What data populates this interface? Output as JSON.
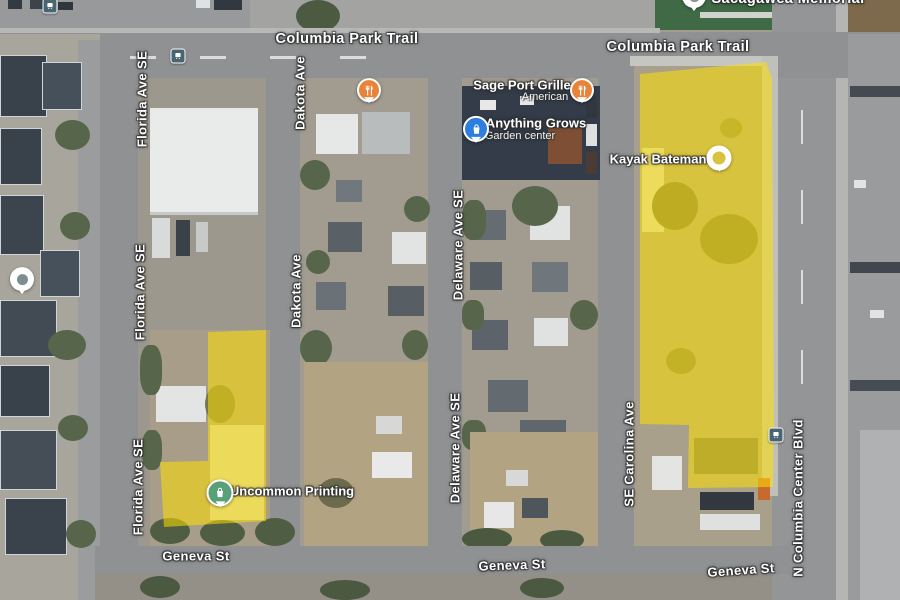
{
  "map": {
    "view": "satellite",
    "street_labels": [
      {
        "text": "Columbia Park Trail"
      },
      {
        "text": "Columbia Park Trail"
      },
      {
        "text": "Florida Ave SE"
      },
      {
        "text": "Florida Ave SE"
      },
      {
        "text": "Florida Ave SE"
      },
      {
        "text": "Dakota Ave"
      },
      {
        "text": "Dakota Ave"
      },
      {
        "text": "Delaware Ave SE"
      },
      {
        "text": "Delaware Ave SE"
      },
      {
        "text": "SE Carolina Ave"
      },
      {
        "text": "N Columbia Center Blvd"
      },
      {
        "text": "Geneva St"
      },
      {
        "text": "Geneva St"
      },
      {
        "text": "Geneva St"
      },
      {
        "text": "Sacagawea Memorial"
      }
    ],
    "places": [
      {
        "name": "Sage Port Grille",
        "category": "American",
        "icon": "restaurant-pin-icon",
        "color": "#E8833A"
      },
      {
        "name": "Anything Grows",
        "category": "Garden center",
        "icon": "shopping-pin-icon",
        "color": "#2E7DE1"
      },
      {
        "name": "Kayak Bateman",
        "icon": "poi-ring-icon",
        "color": "#FFFFFF"
      },
      {
        "name": "Uncommon Printing",
        "icon": "store-pin-icon",
        "color": "#58A07A"
      }
    ],
    "markers": {
      "unnamed_restaurant_pin": "restaurant-pin-icon",
      "unnamed_place_pin": "white-poi-pin-icon",
      "transit_stops": [
        "bus-stop-icon",
        "bus-stop-icon",
        "bus-stop-icon"
      ]
    },
    "highlights": {
      "color": "#FFE000",
      "opacity": 0.55,
      "parcels": [
        {
          "id": "west-parcel",
          "note": "L-shaped parcel at Uncommon Printing"
        },
        {
          "id": "east-parcel",
          "note": "large parcel at Kayak Bateman"
        }
      ]
    }
  }
}
